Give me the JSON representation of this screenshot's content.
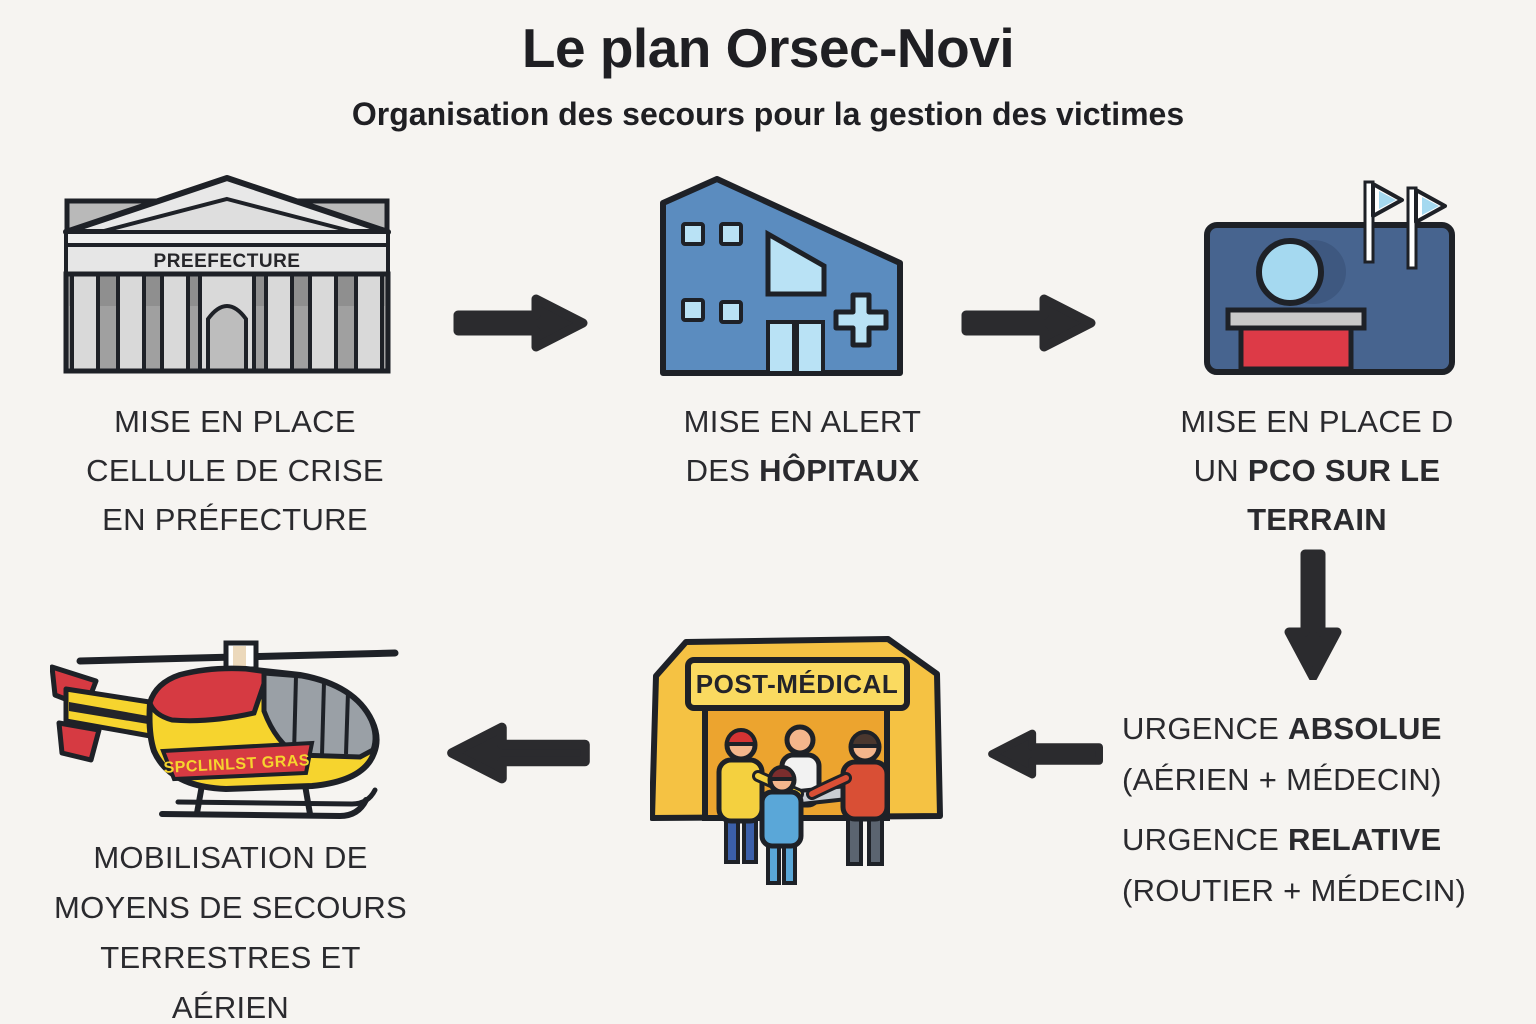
{
  "header": {
    "title": "Le plan Orsec-Novi",
    "subtitle": "Organisation des secours pour la gestion des victimes"
  },
  "nodes": {
    "prefecture": {
      "icon": "prefecture-building-icon",
      "sign_label": "PREEFECTURE",
      "caption": {
        "lines": [
          {
            "parts": [
              {
                "text": "MISE EN PLACE",
                "bold": false
              }
            ]
          },
          {
            "parts": [
              {
                "text": "CELLULE DE CRISE",
                "bold": false
              }
            ]
          },
          {
            "parts": [
              {
                "text": "EN PRÉFECTURE",
                "bold": false
              }
            ]
          }
        ]
      }
    },
    "hospital": {
      "icon": "hospital-icon",
      "caption": {
        "lines": [
          {
            "parts": [
              {
                "text": "MISE EN ALERT",
                "bold": false
              }
            ]
          },
          {
            "parts": [
              {
                "text": "DES ",
                "bold": false
              },
              {
                "text": "HÔPITAUX",
                "bold": true
              }
            ]
          }
        ]
      }
    },
    "pco": {
      "icon": "pco-command-post-icon",
      "caption": {
        "lines": [
          {
            "parts": [
              {
                "text": "MISE EN PLACE D",
                "bold": false
              }
            ]
          },
          {
            "parts": [
              {
                "text": "UN ",
                "bold": false
              },
              {
                "text": "PCO SUR LE",
                "bold": true
              }
            ]
          },
          {
            "parts": [
              {
                "text": "TERRAIN",
                "bold": true
              }
            ]
          }
        ]
      }
    },
    "urgences": {
      "lines": [
        {
          "parts": [
            {
              "text": "URGENCE ",
              "bold": false
            },
            {
              "text": "ABSOLUE",
              "bold": true
            }
          ]
        },
        {
          "parts": [
            {
              "text": "(AÉRIEN + MÉDECIN)",
              "bold": false
            }
          ]
        },
        {
          "parts": [
            {
              "text": "URGENCE ",
              "bold": false
            },
            {
              "text": "RELATIVE",
              "bold": true
            }
          ]
        },
        {
          "parts": [
            {
              "text": "(ROUTIER + MÉDECIN)",
              "bold": false
            }
          ]
        }
      ]
    },
    "medical_post": {
      "icon": "medical-tent-icon",
      "sign_label": "POST-MÉDICAL"
    },
    "helicopter": {
      "icon": "helicopter-icon",
      "marking_label": "SPCLINLST GRAS",
      "caption": {
        "lines": [
          {
            "parts": [
              {
                "text": "MOBILISATION DE",
                "bold": false
              }
            ]
          },
          {
            "parts": [
              {
                "text": "MOYENS DE SECOURS",
                "bold": false
              }
            ]
          },
          {
            "parts": [
              {
                "text": "TERRESTRES ET",
                "bold": false
              }
            ]
          },
          {
            "parts": [
              {
                "text": "AÉRIEN",
                "bold": false
              }
            ]
          }
        ]
      }
    }
  },
  "arrows": [
    {
      "name": "arrow-prefecture-to-hospital",
      "direction": "right"
    },
    {
      "name": "arrow-hospital-to-pco",
      "direction": "right"
    },
    {
      "name": "arrow-pco-to-urgences",
      "direction": "down"
    },
    {
      "name": "arrow-urgences-to-medical-post",
      "direction": "left"
    },
    {
      "name": "arrow-medical-post-to-helicopter",
      "direction": "left"
    }
  ],
  "colors": {
    "background": "#f6f4f1",
    "text": "#2a2a2e",
    "arrow": "#2b2b2e",
    "outline": "#1e2127",
    "building_gray_light": "#e8e8e8",
    "building_gray_mid": "#b9b9b9",
    "building_gray_dark": "#a0a0a0",
    "hospital_blue": "#5b8cbf",
    "window_blue": "#b9e2f5",
    "pco_navy": "#47648f",
    "podium_red": "#dd3a47",
    "podium_gray": "#c9c9c9",
    "tent_yellow": "#f5c243",
    "tent_sign_yellow": "#fada60",
    "tent_interior": "#eca42f",
    "heli_red": "#d63a42",
    "heli_yellow": "#f6d42e",
    "heli_window_gray": "#9aa0a6"
  }
}
